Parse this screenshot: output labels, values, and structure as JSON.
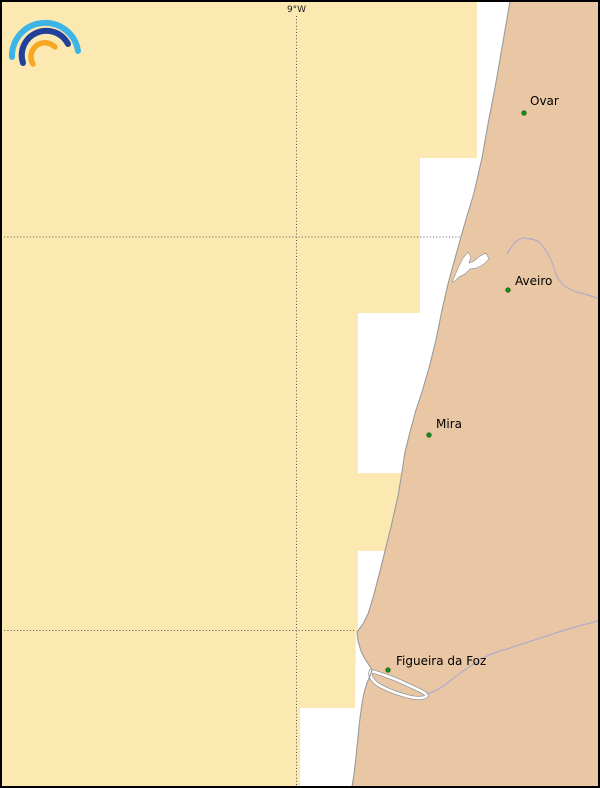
{
  "app": {
    "logo_icon": "meteored-rainbow-logo"
  },
  "map": {
    "gridline_label": "9°W",
    "gridlines": {
      "meridian_x": 296.5,
      "parallels_y": [
        237,
        630.5
      ]
    },
    "cities": [
      {
        "name": "Ovar",
        "dot": {
          "x": 524,
          "y": 113
        },
        "label": {
          "x": 530,
          "y": 105
        }
      },
      {
        "name": "Aveiro",
        "dot": {
          "x": 508,
          "y": 290
        },
        "label": {
          "x": 515,
          "y": 285
        }
      },
      {
        "name": "Mira",
        "dot": {
          "x": 429,
          "y": 435
        },
        "label": {
          "x": 436,
          "y": 428
        }
      },
      {
        "name": "Figueira da Foz",
        "dot": {
          "x": 388,
          "y": 670
        },
        "label": {
          "x": 396,
          "y": 665
        }
      }
    ],
    "named_features": [
      "coastline",
      "aveiro-lagoon",
      "figueira-estuary",
      "river-near-aveiro",
      "mondego-river"
    ]
  },
  "theme": {
    "sea": "#ffffff",
    "warning": "#fce9b2",
    "land": "#eac7a4",
    "coast": "#9a9a9a",
    "river": "#b3abce",
    "grid": "#555555",
    "frame": "#000000",
    "cityDot": "#1d8a1d",
    "cityEdge": "#0b5c0b",
    "labelColor": "#000000",
    "logoCyan": "#3cb4e6",
    "logoBlue": "#21409a",
    "logoOrange": "#f7a823"
  }
}
